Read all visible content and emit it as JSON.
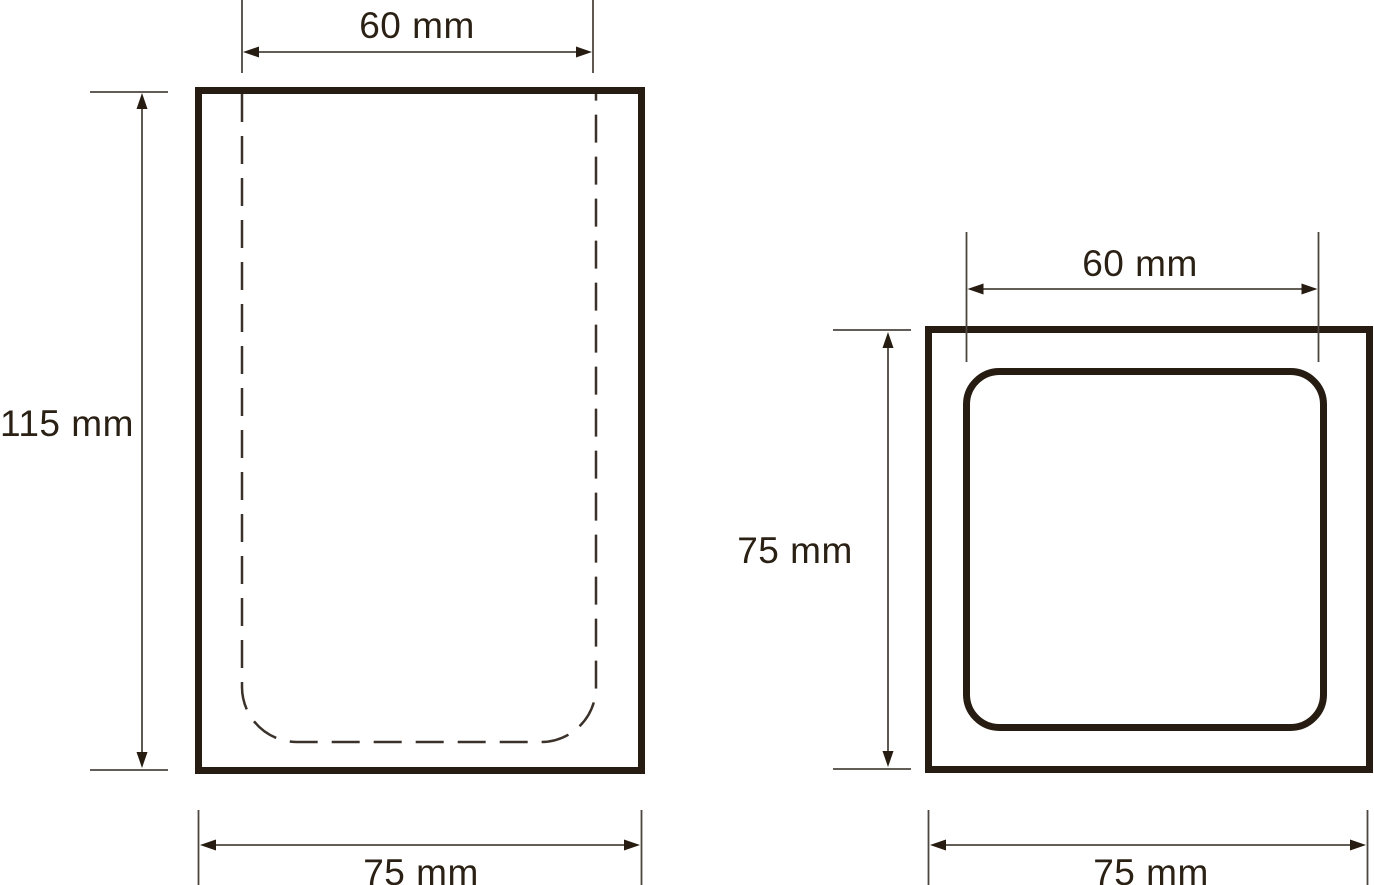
{
  "diagram": {
    "unit": "mm",
    "colors": {
      "background": "#ffffff",
      "thick_line": "#271c11",
      "thin_line": "#4c463e",
      "dashed_line": "#3a322a",
      "text": "#2a2014"
    },
    "front_view": {
      "outer": {
        "width_mm": 75,
        "height_mm": 115
      },
      "inner": {
        "width_mm": 60
      },
      "labels": {
        "top": "60 mm",
        "left": "115 mm",
        "bottom": "75 mm"
      }
    },
    "top_view": {
      "outer": {
        "width_mm": 75,
        "height_mm": 75
      },
      "inner": {
        "width_mm": 60
      },
      "labels": {
        "top": "60 mm",
        "left": "75 mm",
        "bottom": "75 mm"
      }
    }
  }
}
